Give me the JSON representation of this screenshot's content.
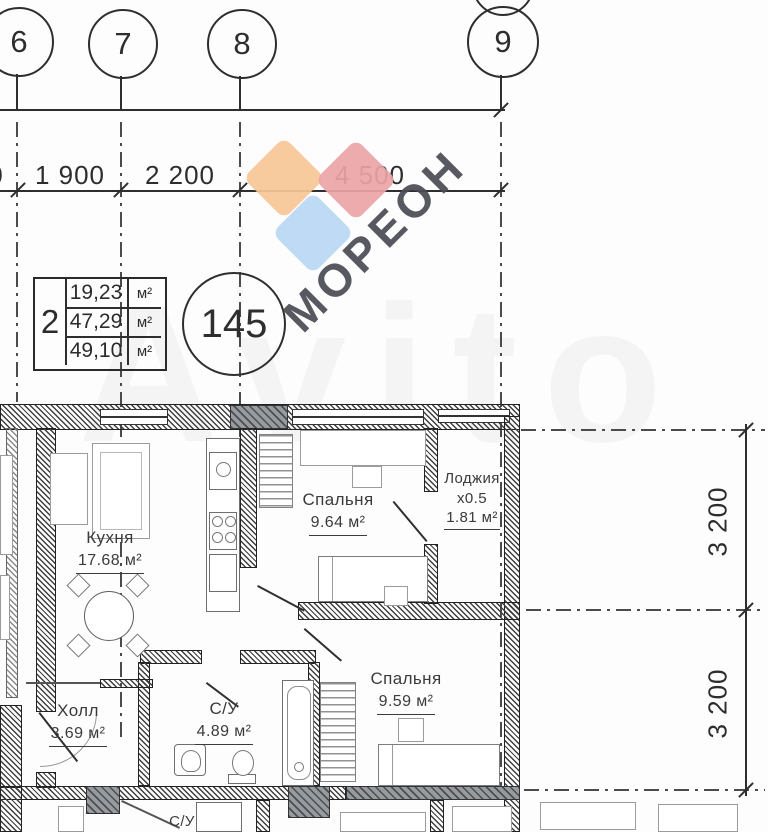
{
  "axes": {
    "c6": "6",
    "c7": "7",
    "c8": "8",
    "c9": "9"
  },
  "dims": {
    "left_cut": "0",
    "h1": "1 900",
    "h2": "2 200",
    "h3": "4 500",
    "v1": "3 200",
    "v2": "3 200"
  },
  "unit_table": {
    "room_count": "2",
    "rows": [
      {
        "value": "19,23",
        "unit": "м²"
      },
      {
        "value": "47,29",
        "unit": "м²"
      },
      {
        "value": "49,10",
        "unit": "м²"
      }
    ]
  },
  "apartment_number": "145",
  "rooms": {
    "kitchen": {
      "name": "Кухня",
      "area": "17.68 м²"
    },
    "bedroom1": {
      "name": "Спальня",
      "area": "9.64 м²"
    },
    "loggia": {
      "name": "Лоджия",
      "coef": "х0.5",
      "area": "1.81 м²"
    },
    "bedroom2": {
      "name": "Спальня",
      "area": "9.59 м²"
    },
    "hall": {
      "name": "Холл",
      "area": "3.69 м²"
    },
    "bathroom": {
      "name": "С/У",
      "area": "4.89 м²"
    }
  },
  "neighbor_below": {
    "bathroom_label": "С/У"
  },
  "watermarks": {
    "brand_text": "МОРЕОН",
    "site_text": "Avito"
  },
  "colors": {
    "drawing_line": "#2e2e2e",
    "brand_text": "#4c4c55",
    "diamond_orange": "#f6c795",
    "diamond_red": "#eba4a6",
    "diamond_blue": "#b9d7f3"
  }
}
